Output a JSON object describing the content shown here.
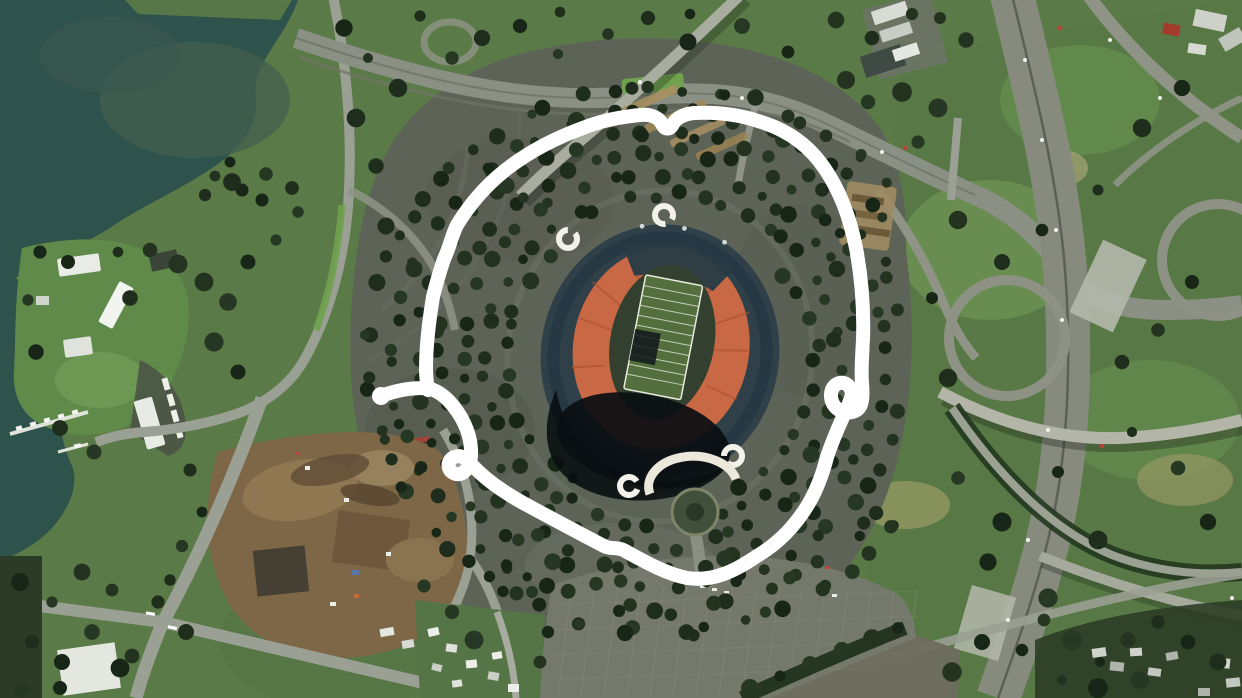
{
  "scene": {
    "type": "satellite-imagery",
    "subject": "aerial view of an oval stadium (orange seating bowl, green football field) surrounded by rings of tree-lined parking lots, a marina shoreline to the west, a freeway interchange to the east and a dirt construction site to the southwest",
    "annotation": {
      "kind": "hand-drawn freehand circle",
      "target": "stadium and its surrounding parking ring",
      "color": "#ffffff",
      "stroke_width": 14
    }
  },
  "palette": {
    "grass": "#5a7a47",
    "grass_light": "#6e9254",
    "grass_pale": "#9a9a66",
    "water": "#2e524c",
    "water_murky": "#44604f",
    "asphalt": "#5e6358",
    "asphalt_light": "#75796b",
    "road": "#9ba094",
    "freeway": "#868b7e",
    "tree_dark": "#1e2d1c",
    "stadium_roof": "#2f4049",
    "stadium_seating": "#c96845",
    "field_green": "#546f3e",
    "shadow_black": "#0a0e12",
    "dirt_brown": "#7d6747",
    "sand_tan": "#a99060",
    "building_white": "#e9ece6",
    "annotation_white": "#ffffff"
  }
}
